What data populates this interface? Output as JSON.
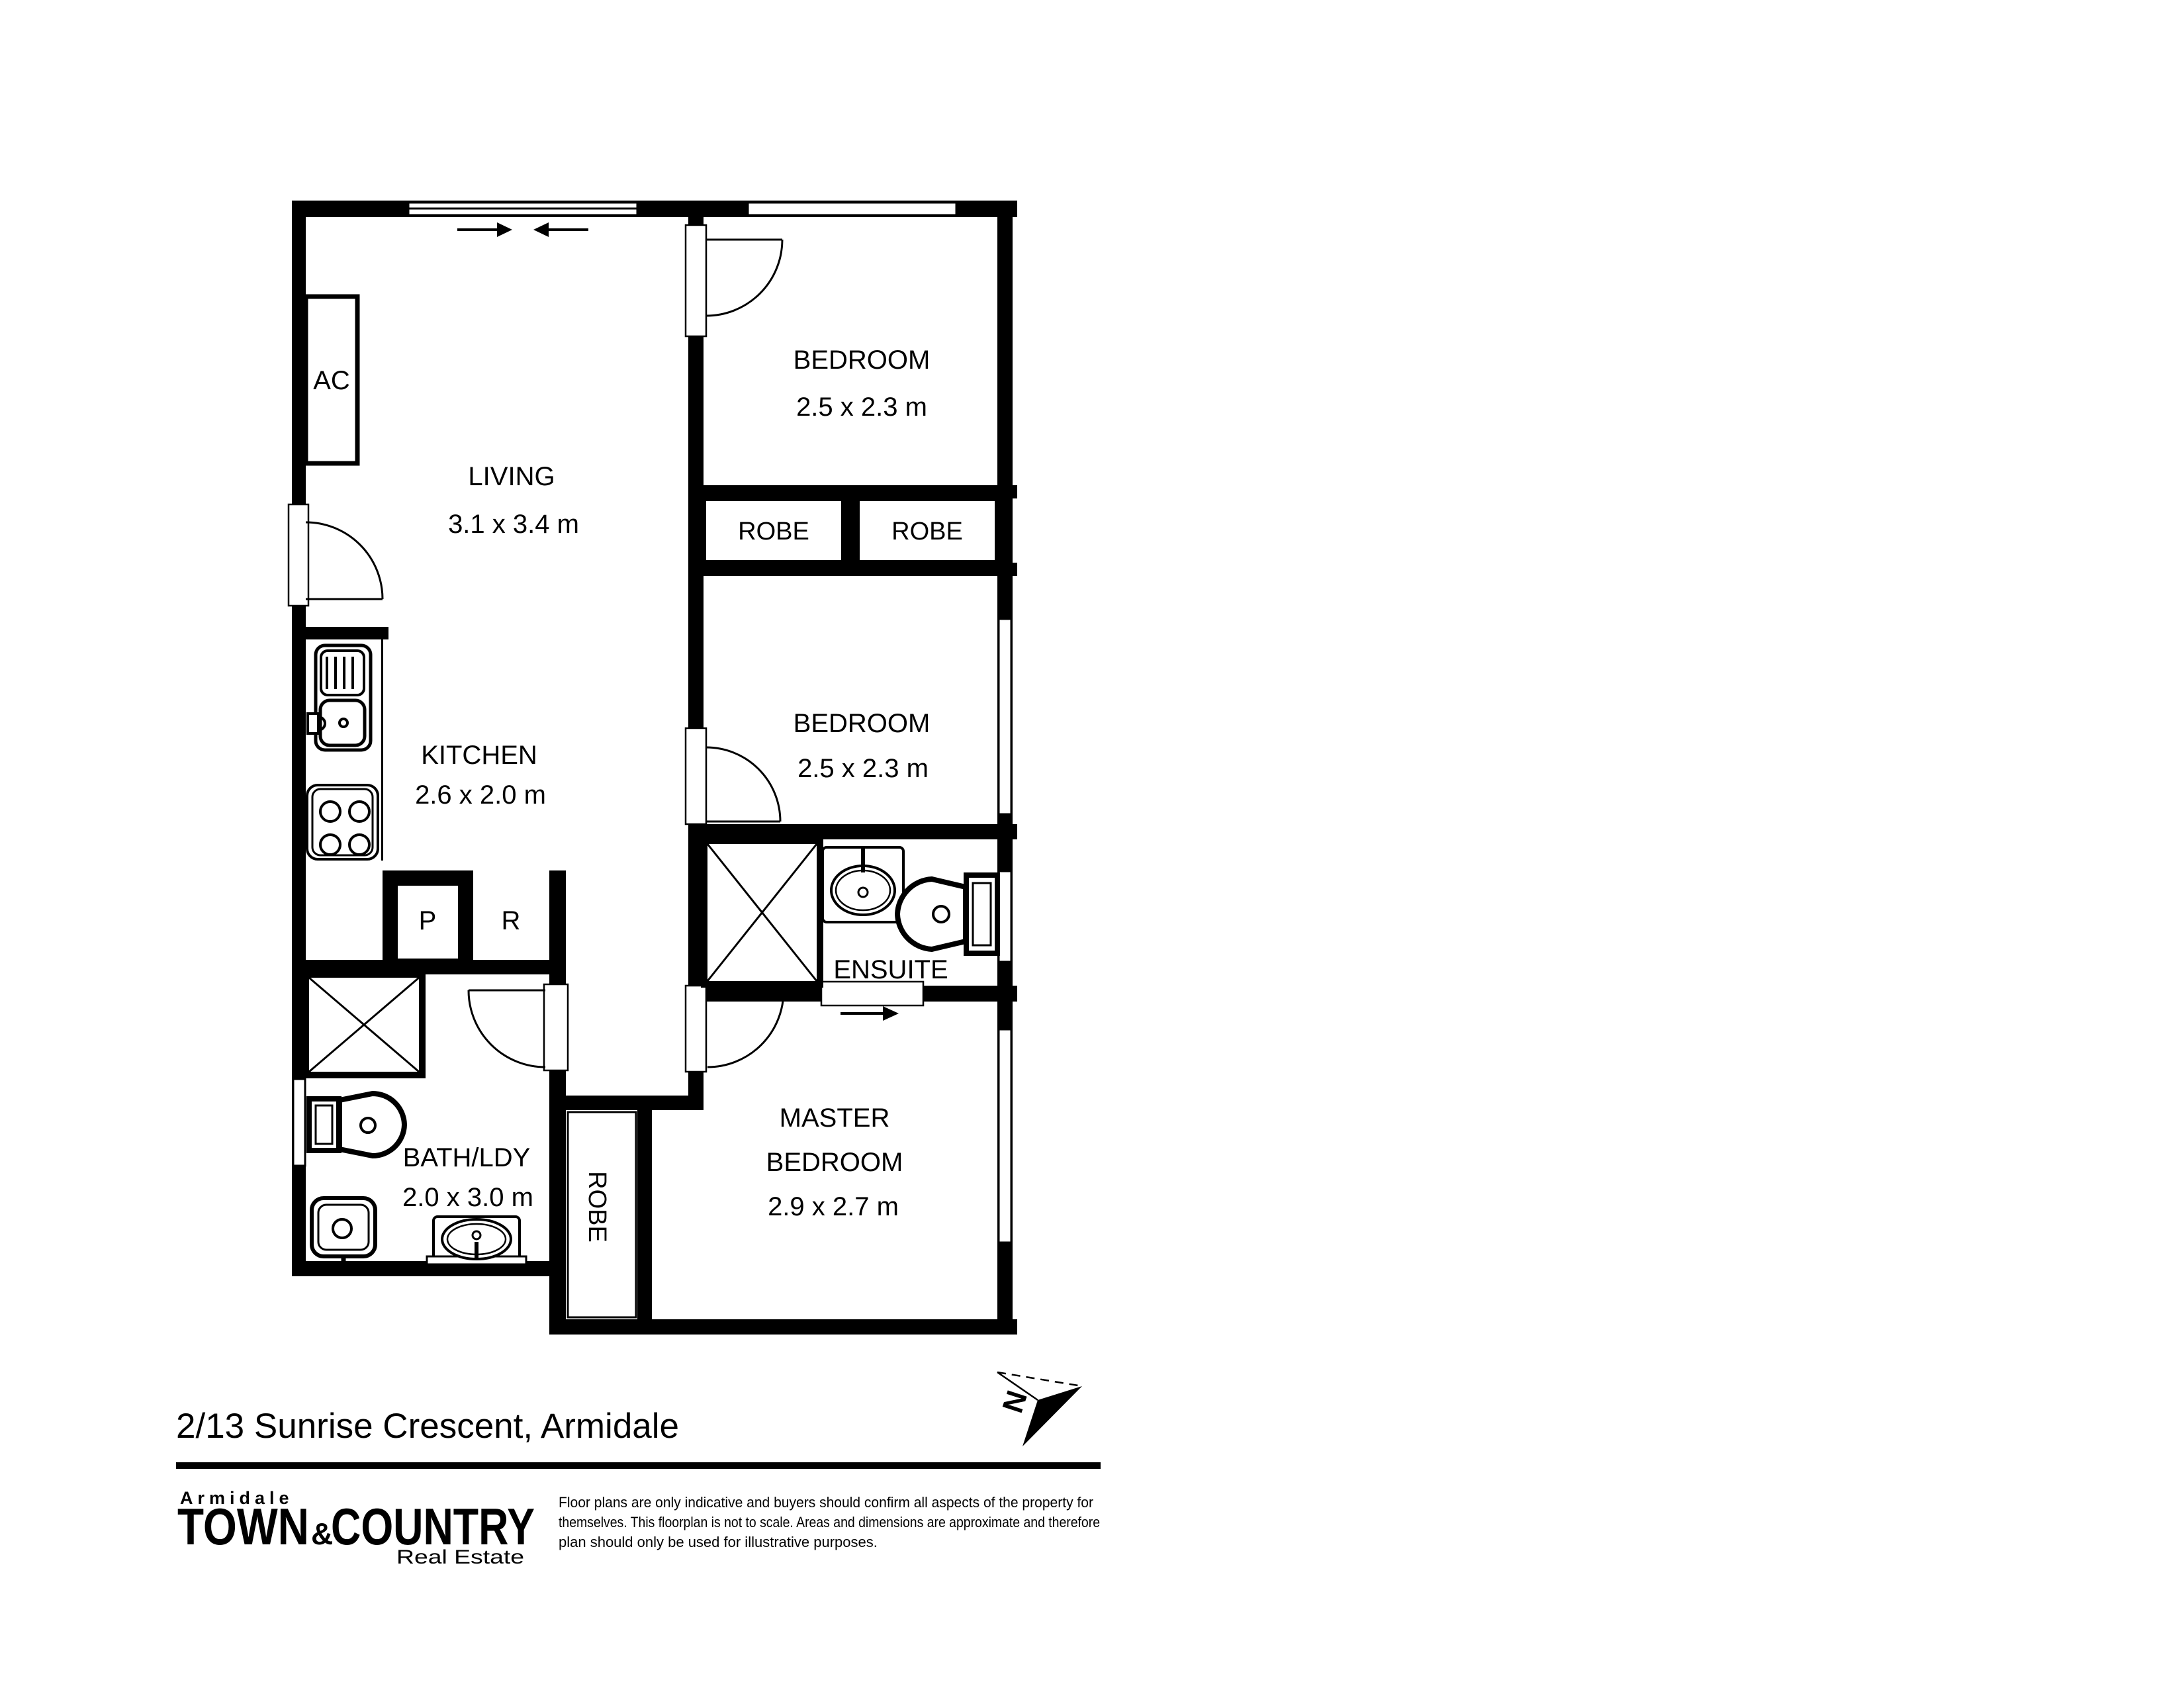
{
  "address": "2/13 Sunrise Crescent, Armidale",
  "compass": {
    "north_label": "N"
  },
  "rooms": {
    "living": {
      "name": "LIVING",
      "dims": "3.1 x 3.4 m"
    },
    "bedroom1": {
      "name": "BEDROOM",
      "dims": "2.5 x 2.3 m"
    },
    "bedroom2": {
      "name": "BEDROOM",
      "dims": "2.5 x 2.3 m"
    },
    "kitchen": {
      "name": "KITCHEN",
      "dims": "2.6 x 2.0 m"
    },
    "ensuite": {
      "name": "ENSUITE"
    },
    "bath": {
      "name": "BATH/LDY",
      "dims": "2.0 x 3.0 m"
    },
    "master": {
      "name1": "MASTER",
      "name2": "BEDROOM",
      "dims": "2.9 x 2.7 m"
    },
    "robe1": "ROBE",
    "robe2": "ROBE",
    "robe_master": "ROBE",
    "pantry": "P",
    "fridge": "R",
    "ac": "AC"
  },
  "footer": {
    "logo": {
      "top": "Armidale",
      "town": "TOWN",
      "amp": "&",
      "country": "COUNTRY",
      "tagline": "Real Estate",
      "navy": "#26348b",
      "yellow": "#ffd900",
      "gray": "#9b9b9b",
      "light_gray": "#a9a9a9"
    },
    "disclaimer": [
      "Floor plans are only indicative and buyers should confirm all aspects of the property for",
      "themselves. This floorplan is not to scale. Areas and dimensions are approximate and therefore",
      "plan should only be used for illustrative purposes."
    ]
  }
}
